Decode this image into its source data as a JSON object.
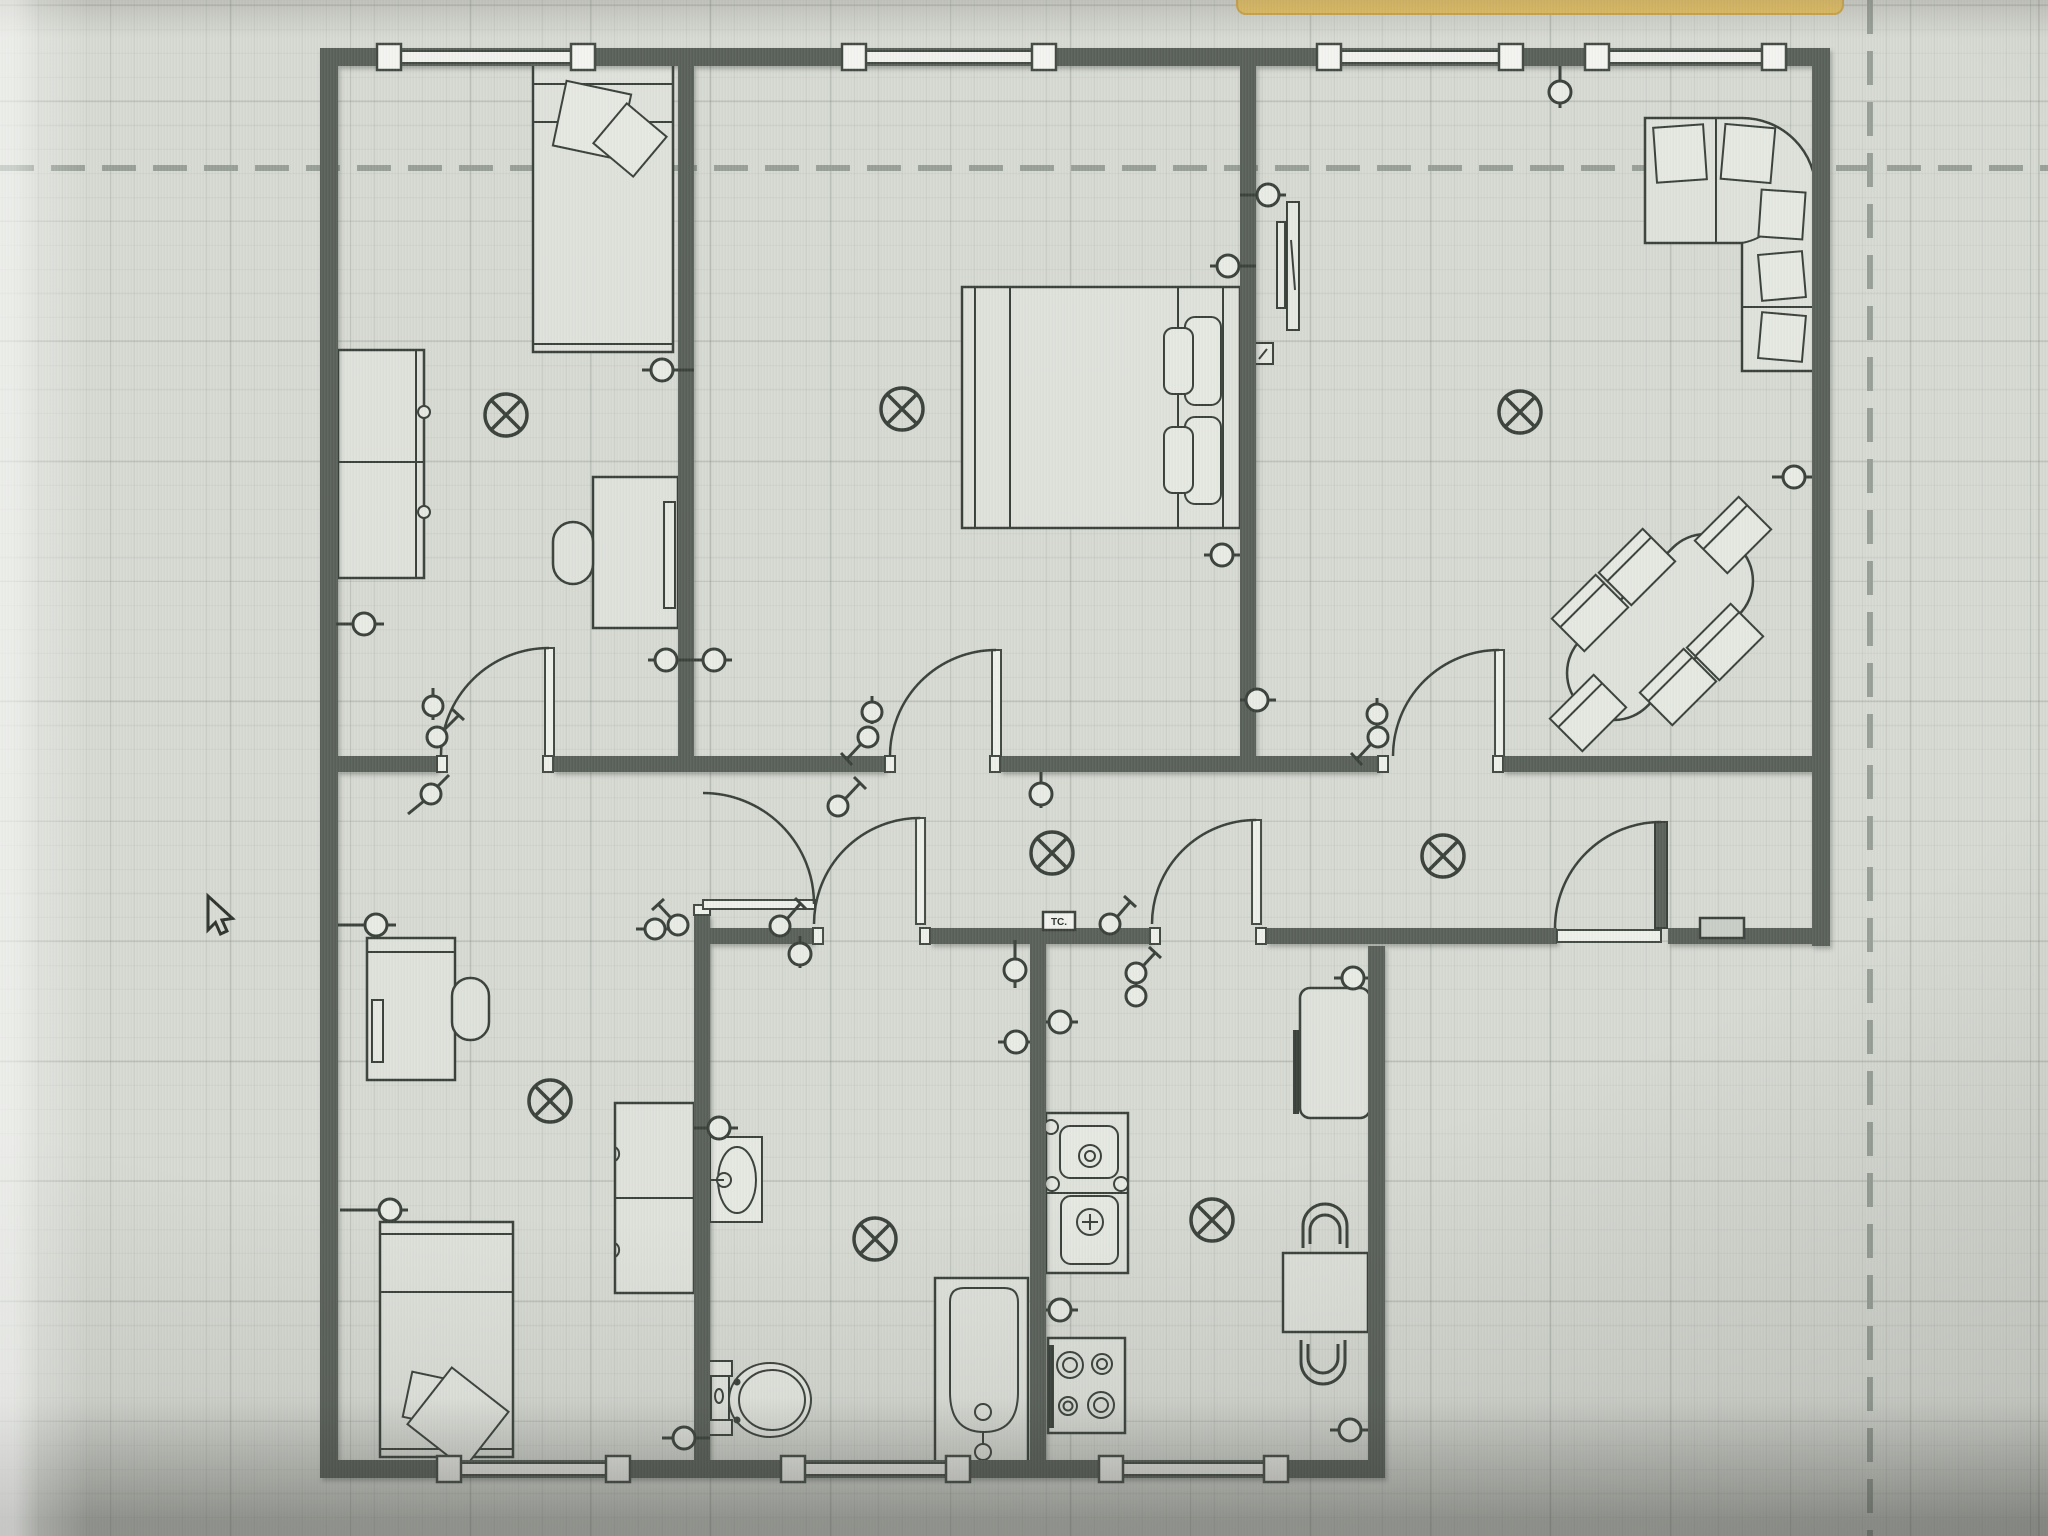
{
  "window": {
    "background_app_bar_color": "#e9c35f",
    "cursor_visible": true
  },
  "canvas": {
    "type": "floor-plan-grid-paper",
    "grid_minor_px": 24,
    "grid_major_px": 120,
    "page_boundary_style": "dashed"
  },
  "labels": {
    "tc_box": "TC."
  },
  "colors": {
    "wall": "#5a615a",
    "line": "#3a413b",
    "canvas": "#d7dad3",
    "dashed_boundary": "#98a097",
    "yellow_bar": "#e9c35f"
  },
  "plan_inventory": {
    "ceiling_light_count": 8,
    "socket_count": 22,
    "switch_count": 8,
    "door_count": 7,
    "window_count": 7,
    "fixtures": [
      "single-bed",
      "double-bed",
      "single-bed",
      "wardrobe",
      "wardrobe",
      "desk",
      "desk",
      "desk-chair",
      "desk-chair",
      "corner-sofa",
      "tv",
      "dining-table",
      "dining-chairs-6",
      "fridge",
      "kitchen-sink-unit",
      "stove",
      "kitchen-table",
      "kitchen-chairs-2",
      "bath-sink",
      "toilet",
      "bathtub"
    ]
  }
}
